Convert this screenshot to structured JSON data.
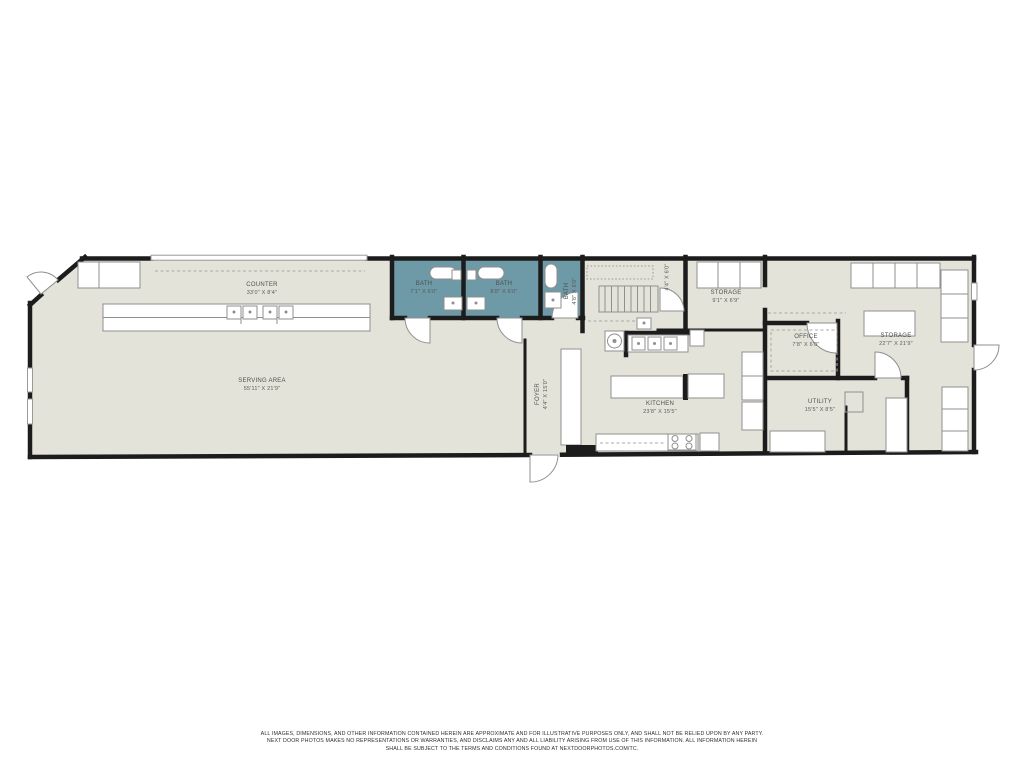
{
  "document": {
    "type": "floor-plan"
  },
  "colors": {
    "page_bg": "#ffffff",
    "floor": "#e4e3da",
    "bath": "#6e99a7",
    "wall": "#1c1c1c",
    "fixture": "#8f8f8f",
    "label": "#4f4f4f"
  },
  "rooms": {
    "counter": {
      "name": "COUNTER",
      "dims": "33'0\" X 8'4\""
    },
    "serving_area": {
      "name": "SERVING AREA",
      "dims": "55'11\" X 21'9\""
    },
    "bath_1": {
      "name": "BATH",
      "dims": "7'1\" X 6'0\""
    },
    "bath_2": {
      "name": "BATH",
      "dims": "8'8\" X 6'0\""
    },
    "bath_3": {
      "name": "BATH",
      "dims": "4'8\" X 6'0\""
    },
    "foyer": {
      "name": "FOYER",
      "dims": "4'4\" X 15'0\""
    },
    "kitchen": {
      "name": "KITCHEN",
      "dims": "23'8\" X 15'5\""
    },
    "storage_small": {
      "name": "STORAGE",
      "dims": "9'1\" X 6'9\""
    },
    "storage_large": {
      "name": "STORAGE",
      "dims": "22'7\" X 21'9\""
    },
    "office": {
      "name": "OFFICE",
      "dims": "7'8\" X 6'0\""
    },
    "utility": {
      "name": "UTILITY",
      "dims": "15'5\" X 8'5\""
    },
    "hall": {
      "name": "",
      "dims": "4'4\" X 6'0\""
    }
  },
  "disclaimer": {
    "line1": "ALL IMAGES, DIMENSIONS, AND OTHER INFORMATION CONTAINED HEREIN ARE APPROXIMATE AND FOR ILLUSTRATIVE PURPOSES ONLY, AND SHALL NOT BE RELIED UPON BY ANY PARTY.",
    "line2": "NEXT DOOR PHOTOS MAKES NO REPRESENTATIONS OR WARRANTIES, AND DISCLAIMS ANY AND ALL LIABILITY ARISING FROM USE OF THIS INFORMATION. ALL INFORMATION HEREIN",
    "line3": "SHALL BE SUBJECT TO THE TERMS AND CONDITIONS FOUND AT NEXTDOORPHOTOS.COM/TC."
  }
}
